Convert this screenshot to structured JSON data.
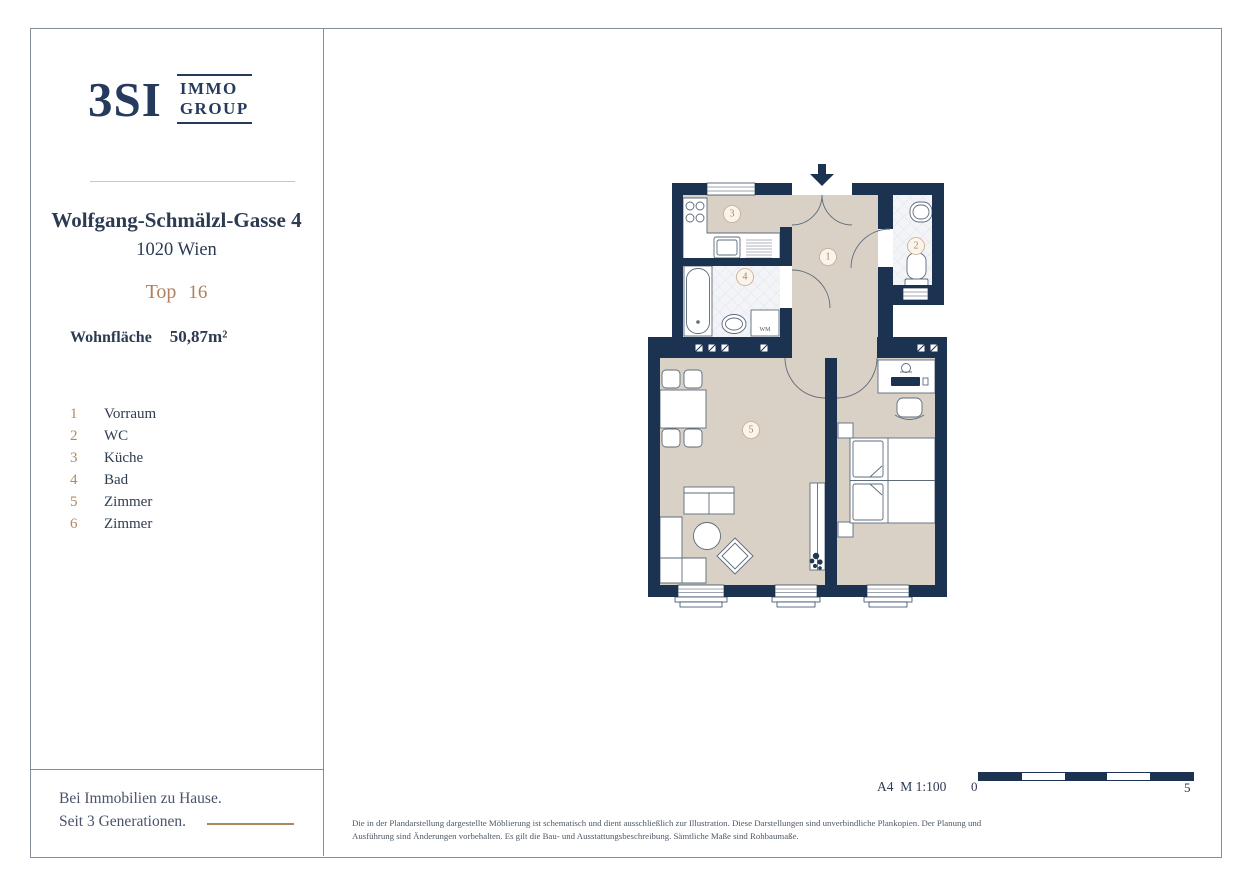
{
  "brand": {
    "logo_text": "3SI",
    "logo_sub1": "IMMO",
    "logo_sub2": "GROUP"
  },
  "property": {
    "address": "Wolfgang-Schmälzl-Gasse 4",
    "city": "1020 Wien",
    "unit_label": "Top",
    "unit_number": "16",
    "area_label": "Wohnfläche",
    "area_value": "50,87m²"
  },
  "legend": {
    "rooms": [
      {
        "num": "1",
        "label": "Vorraum"
      },
      {
        "num": "2",
        "label": "WC"
      },
      {
        "num": "3",
        "label": "Küche"
      },
      {
        "num": "4",
        "label": "Bad"
      },
      {
        "num": "5",
        "label": "Zimmer"
      },
      {
        "num": "6",
        "label": "Zimmer"
      }
    ]
  },
  "plan": {
    "badges": {
      "b1": "1",
      "b2": "2",
      "b3": "3",
      "b4": "4",
      "b5": "5"
    },
    "wm_label": "WM"
  },
  "footer": {
    "slogan_line1": "Bei Immobilien zu Hause.",
    "slogan_line2": "Seit 3 Generationen.",
    "scale_text": "A4  M 1:100",
    "scale_start": "0",
    "scale_end": "5",
    "disclaimer": "Die in der Plandarstellung dargestellte Möblierung ist schematisch und dient ausschließlich zur Illustration. Diese Darstellungen sind unverbindliche Plankopien. Der Planung und Ausführung sind Änderungen vorbehalten. Es gilt die Bau- und Ausstattungsbeschreibung. Sämtliche Maße sind Rohbaumaße."
  }
}
